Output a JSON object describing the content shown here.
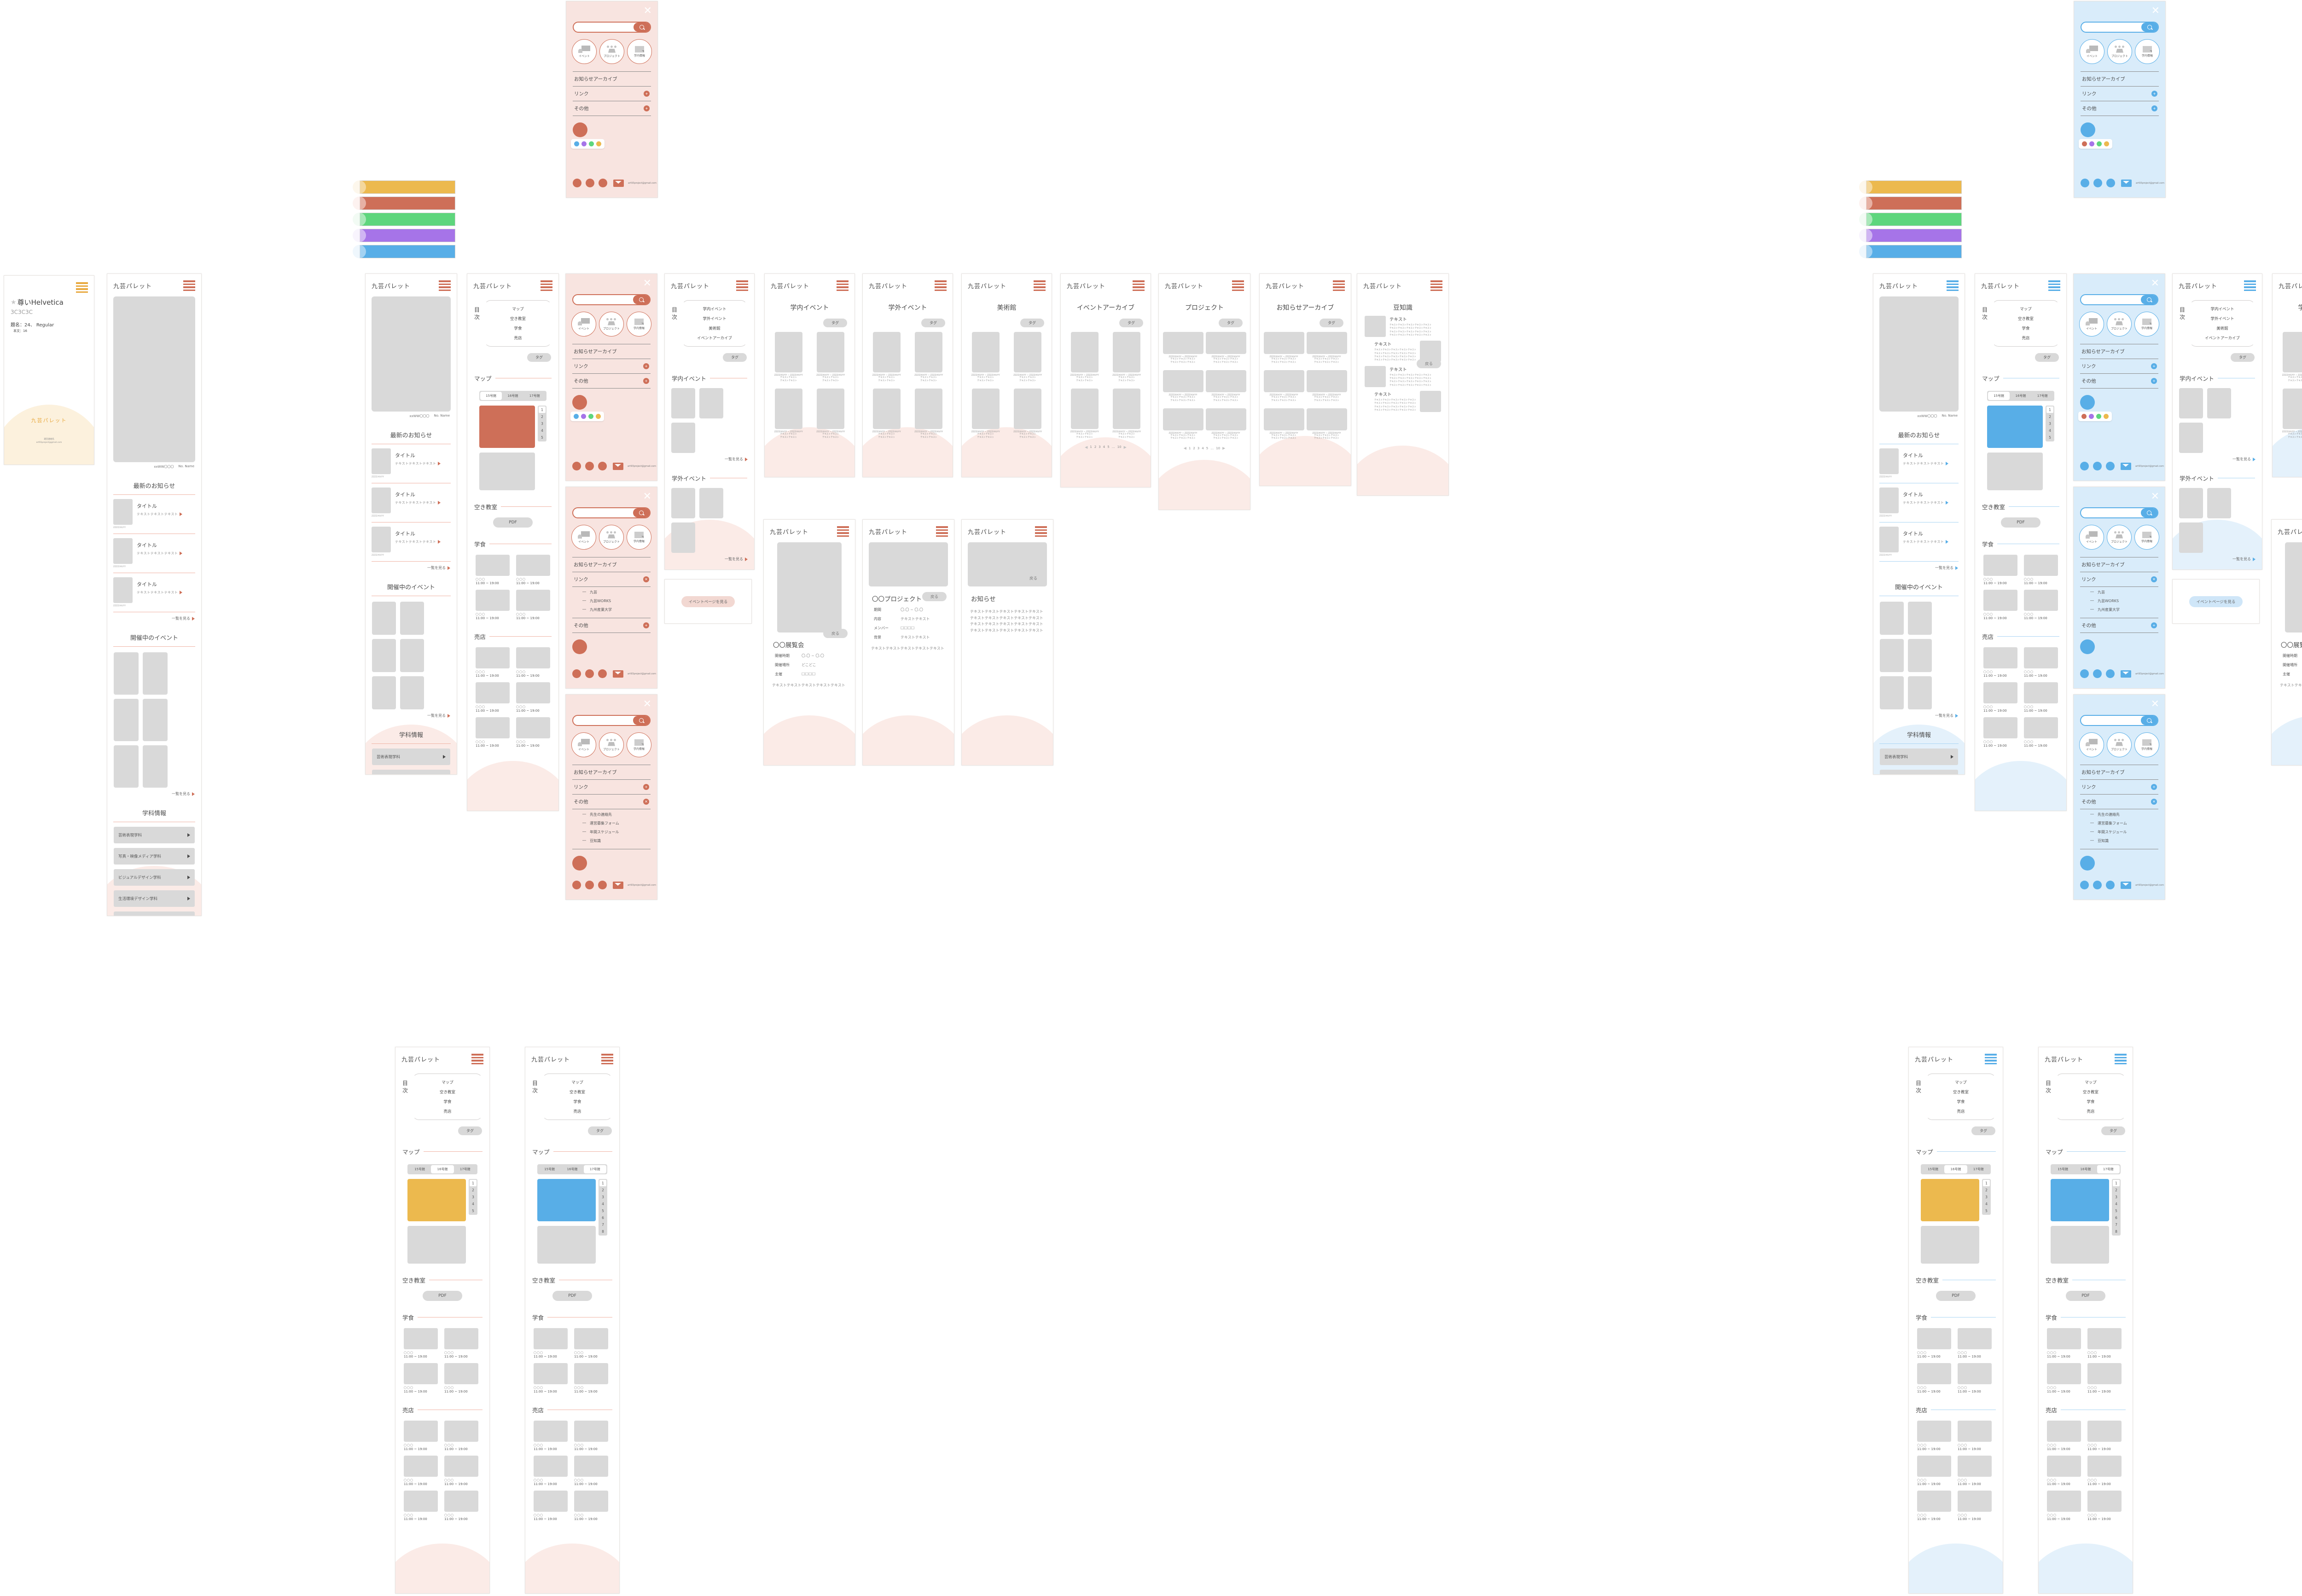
{
  "brand": "九芸パレット",
  "colors": {
    "accent_red": "#CE6F58",
    "accent_blue": "#58AEE7",
    "yellow": "#ECB94E",
    "green": "#5ED67D",
    "purple": "#A674E8",
    "gray_placeholder": "#D9D9D9",
    "pink_bg": "#F8E4E0",
    "pink_arch": "#FBEBE7",
    "blue_bg": "#D9ECFA",
    "blue_arch": "#E4F1FB",
    "cream_arch": "#FCF1DD",
    "orange": "#E8A93F",
    "palette_bars": [
      "#ECB94E",
      "#CE6F58",
      "#5ED67D",
      "#A674E8",
      "#58AEE7"
    ],
    "pastel_circles": [
      "#FBF0DC",
      "#FBE8E4",
      "#E8F7EB",
      "#F2EBFC",
      "#E2F0FB"
    ],
    "swatch_popup_red": [
      "#58AEE7",
      "#A674E8",
      "#5ED67D",
      "#ECB94E"
    ],
    "swatch_popup_blue": [
      "#CE6F58",
      "#A674E8",
      "#5ED67D",
      "#ECB94E"
    ]
  },
  "common": {
    "tag": "タグ",
    "see_all": "一覧を見る",
    "back": "戻る",
    "date": "ZZZZ/XX/YY",
    "date_range": "ZZZZ/XX/YY ~ ZZZZ/XX/YY",
    "tx8": "テキストテキスト",
    "tx12": "テキストテキストテキスト",
    "tx_line": "テキストテキストテキストテキストテキスト",
    "pagination": [
      "1",
      "2",
      "3",
      "4",
      "5",
      "…",
      "10"
    ],
    "prev": "◀",
    "next": "▶",
    "dash": "―"
  },
  "spec": {
    "star": "★",
    "title": "尊いHelvetica",
    "code": "3C3C3C",
    "size_title": "題名：24、 Regular",
    "size_body": "本文：16",
    "brand": "九芸パレット",
    "contact": "運営連絡先",
    "email": "art93project@gmail.com"
  },
  "menu": {
    "close": "✕",
    "labels": [
      "イベント",
      "プロジェクト",
      "学内情報"
    ],
    "archive": "お知らせアーカイブ",
    "link": "リンク",
    "other": "その他",
    "link_items": [
      "九芸",
      "九芸WORKS",
      "九州産業大学"
    ],
    "other_items": [
      "先生の連絡先",
      "運営募集フォーム",
      "年間スケジュール",
      "豆知識"
    ],
    "plus": "+",
    "close_badge": "✕",
    "email": "art93project@gmail.com"
  },
  "home": {
    "caption_code": "xxWW〇〇〇",
    "caption_name": "No. Name",
    "news": "最新のお知らせ",
    "item_title": "タイトル",
    "events": "開催中のイベント",
    "dept": "学科情報",
    "departments": [
      "芸術表現学科",
      "写真・映像メディア学科",
      "ビジュアルデザイン学科",
      "生活環境デザイン学科",
      "ソーシャルデザイン学科"
    ]
  },
  "map": {
    "toc_label": "目次",
    "toc": [
      "マップ",
      "空き教室",
      "学食",
      "売店"
    ],
    "section_map": "マップ",
    "section_rooms": "空き教室",
    "section_food": "学食",
    "section_shop": "売店",
    "tabs": [
      "15号館",
      "16号館",
      "17号館"
    ],
    "pdf": "PDF",
    "shop_name": "〇〇〇",
    "hours": "11:00 ~ 19:00",
    "pager": [
      "1",
      "2",
      "3",
      "4",
      "5",
      "6",
      "7",
      "8"
    ]
  },
  "events_index": {
    "toc": [
      "学内イベント",
      "学外イベント",
      "美術館",
      "イベントアーカイブ"
    ]
  },
  "lists": {
    "in_events": "学内イベント",
    "out_events": "学外イベント",
    "museum": "美術館",
    "archive": "イベントアーカイブ",
    "projects": "プロジェクト",
    "notices": "お知らせアーカイブ"
  },
  "trivia": {
    "title": "豆知識",
    "heading": "テキスト"
  },
  "details": {
    "ex": {
      "title": "〇〇展覧会",
      "f1l": "開催時期",
      "f1v": "〇.〇 ~ 〇.〇",
      "f2l": "開催場所",
      "f2v": "どこどこ",
      "f3l": "主催",
      "f3v": "□□□□"
    },
    "pj": {
      "title": "〇〇プロジェクト",
      "f1l": "期間",
      "f1v": "〇.〇 ~ 〇.〇",
      "f2l": "内容",
      "f2v": "テキストテキスト",
      "f3l": "メンバー",
      "f3v": "□□□□",
      "f4l": "背景",
      "f4v": "テキストテキスト"
    },
    "nt": {
      "title": "お知らせ"
    }
  },
  "button_card": {
    "label": "イベントページを見る"
  }
}
